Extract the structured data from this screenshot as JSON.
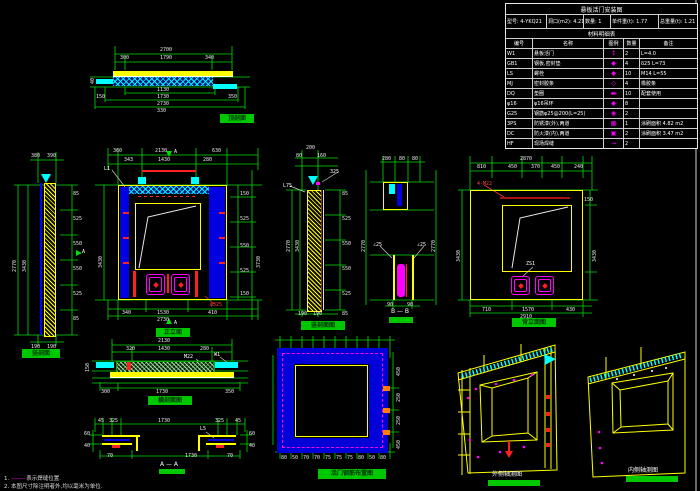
{
  "table": {
    "title": "悬板活门安装图",
    "info": [
      "型号: 4-YKQ21",
      "洞口(m2): 4.21",
      "数量: 1",
      "单件重(t): 1.77",
      "总重量(t): 1.21"
    ],
    "subtitle": "材料明细表",
    "headers": [
      "编号",
      "名称",
      "图例",
      "数量",
      "备注"
    ],
    "rows": [
      {
        "no": "W1",
        "name": "悬板活门",
        "icon": "↕",
        "qty": "2",
        "note": "L=4.0"
      },
      {
        "no": "GB1",
        "name": "钢板,密封垫",
        "icon": "◆",
        "qty": "4",
        "note": "δ25 L=73"
      },
      {
        "no": "LS",
        "name": "螺栓",
        "icon": "◆",
        "qty": "10",
        "note": "M14 L=55"
      },
      {
        "no": "MJ",
        "name": "密封胶条",
        "icon": "◇",
        "qty": "4",
        "note": "橡胶条"
      },
      {
        "no": "DQ",
        "name": "垫圈",
        "icon": "▬",
        "qty": "10",
        "note": "配套使用"
      },
      {
        "no": "φ16",
        "name": "φ16吊环",
        "icon": "◆",
        "qty": "8",
        "note": ""
      },
      {
        "no": "G25",
        "name": "钢筋φ25@200(L=25)",
        "icon": "◉",
        "qty": "2",
        "note": ""
      },
      {
        "no": "3PS",
        "name": "防锈漆(外),两道",
        "icon": "▦",
        "qty": "1",
        "note": "涂刷面积 4.82 m2"
      },
      {
        "no": "DC",
        "name": "防火漆(内),两道",
        "icon": "▣",
        "qty": "2",
        "note": "涂刷面积 3.47 m2"
      },
      {
        "no": "HF",
        "name": "现场焊缝",
        "icon": "→",
        "qty": "2",
        "note": ""
      }
    ]
  },
  "drawings": {
    "d1": {
      "label": "顶剖面",
      "dims": [
        "2700",
        "300",
        "1790",
        "340",
        "1130",
        "150",
        "1730",
        "350",
        "2730",
        "330",
        "40"
      ]
    },
    "d2": {
      "label": "竖剖面",
      "mark": "A",
      "dims": [
        "380",
        "390",
        "2770",
        "3430",
        "85",
        "525",
        "550",
        "550",
        "525",
        "85",
        "190",
        "190"
      ]
    },
    "d3": {
      "label": "正立面",
      "mark_top": "A",
      "mark_bot": "A",
      "red_note": "φ325",
      "leader": "L1",
      "dims": [
        "360",
        "2130",
        "630",
        "343",
        "1430",
        "280",
        "3430",
        "150",
        "525",
        "550",
        "525",
        "150",
        "3730",
        "340",
        "1530",
        "410",
        "2730"
      ]
    },
    "d4": {
      "label": "竖剖面图",
      "leader1": "325",
      "leader2": "L75",
      "dims": [
        "200",
        "80",
        "160",
        "2770",
        "3430",
        "85",
        "525",
        "550",
        "550",
        "525",
        "85",
        "190",
        "190"
      ]
    },
    "d5": {
      "label": "B — B",
      "leader1": "∠25",
      "leader2": "∠25",
      "dims": [
        "280",
        "80",
        "80",
        "2770",
        "2770",
        "90",
        "90"
      ]
    },
    "d6": {
      "label": "背立面图",
      "red_note": "4-M22",
      "leader": "ZS1",
      "dims": [
        "2870",
        "810",
        "450",
        "370",
        "450",
        "240",
        "3430",
        "3430",
        "150",
        "710",
        "1570",
        "430",
        "2910"
      ]
    },
    "d7": {
      "label": "横剖面图",
      "leader1": "M22",
      "leader2": "W1",
      "dims": [
        "2130",
        "320",
        "1430",
        "280",
        "150",
        "300",
        "1730",
        "350"
      ]
    },
    "d8": {
      "label": "A — A",
      "leader": "L5",
      "dims": [
        "45",
        "325",
        "1730",
        "325",
        "45",
        "60",
        "40",
        "60",
        "40",
        "70",
        "1730",
        "70"
      ]
    },
    "d9": {
      "label": "活门钢筋布置图",
      "bottom_row": [
        "80",
        "50",
        "70",
        "70",
        "75",
        "75",
        "75",
        "80",
        "50",
        "80"
      ],
      "right_col": [
        "450",
        "250",
        "250",
        "450"
      ]
    },
    "d10": {
      "label": "外侧轴测图"
    },
    "d11": {
      "label": "内侧轴测图"
    }
  },
  "notes": {
    "n1_num": "1.",
    "n1_sym": "———",
    "n1_text": "表示焊缝位置.",
    "n2": "2. 本图尺寸除注明者外,均以毫米为单位."
  }
}
